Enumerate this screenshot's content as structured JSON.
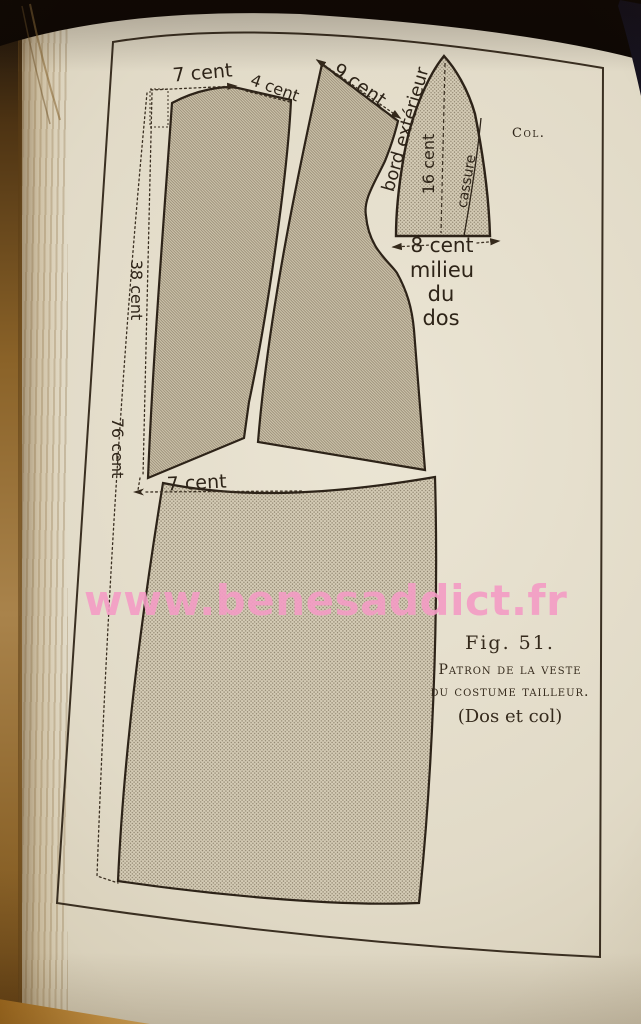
{
  "watermark": {
    "text": "www.benesaddict.fr",
    "color": "#f49cc5"
  },
  "figure": {
    "number": "Fig. 51.",
    "caption_line1": "Patron de la veste",
    "caption_line2": "du costume tailleur.",
    "caption_line3": "(Dos et col)",
    "labels": {
      "top_width": "7 cent",
      "shoulder_width": "4 cent",
      "collar_seam": "9 cent",
      "outer_edge": "bord extérieur",
      "collar_length": "16 cent",
      "break_line": "cassure",
      "collar_abbrev": "Col.",
      "collar_base_width": "8 cent",
      "center_back_1": "milieu",
      "center_back_2": "du",
      "center_back_3": "dos",
      "upper_back_length": "38 cent",
      "total_length": "76 cent",
      "lower_offset": "7 cent"
    },
    "colors": {
      "ink": "#2e2418",
      "paper": "#e1dac7",
      "shading": "#cfc5ad",
      "watermark_pink": "#f49cc5",
      "wood": "#c2883c"
    }
  }
}
